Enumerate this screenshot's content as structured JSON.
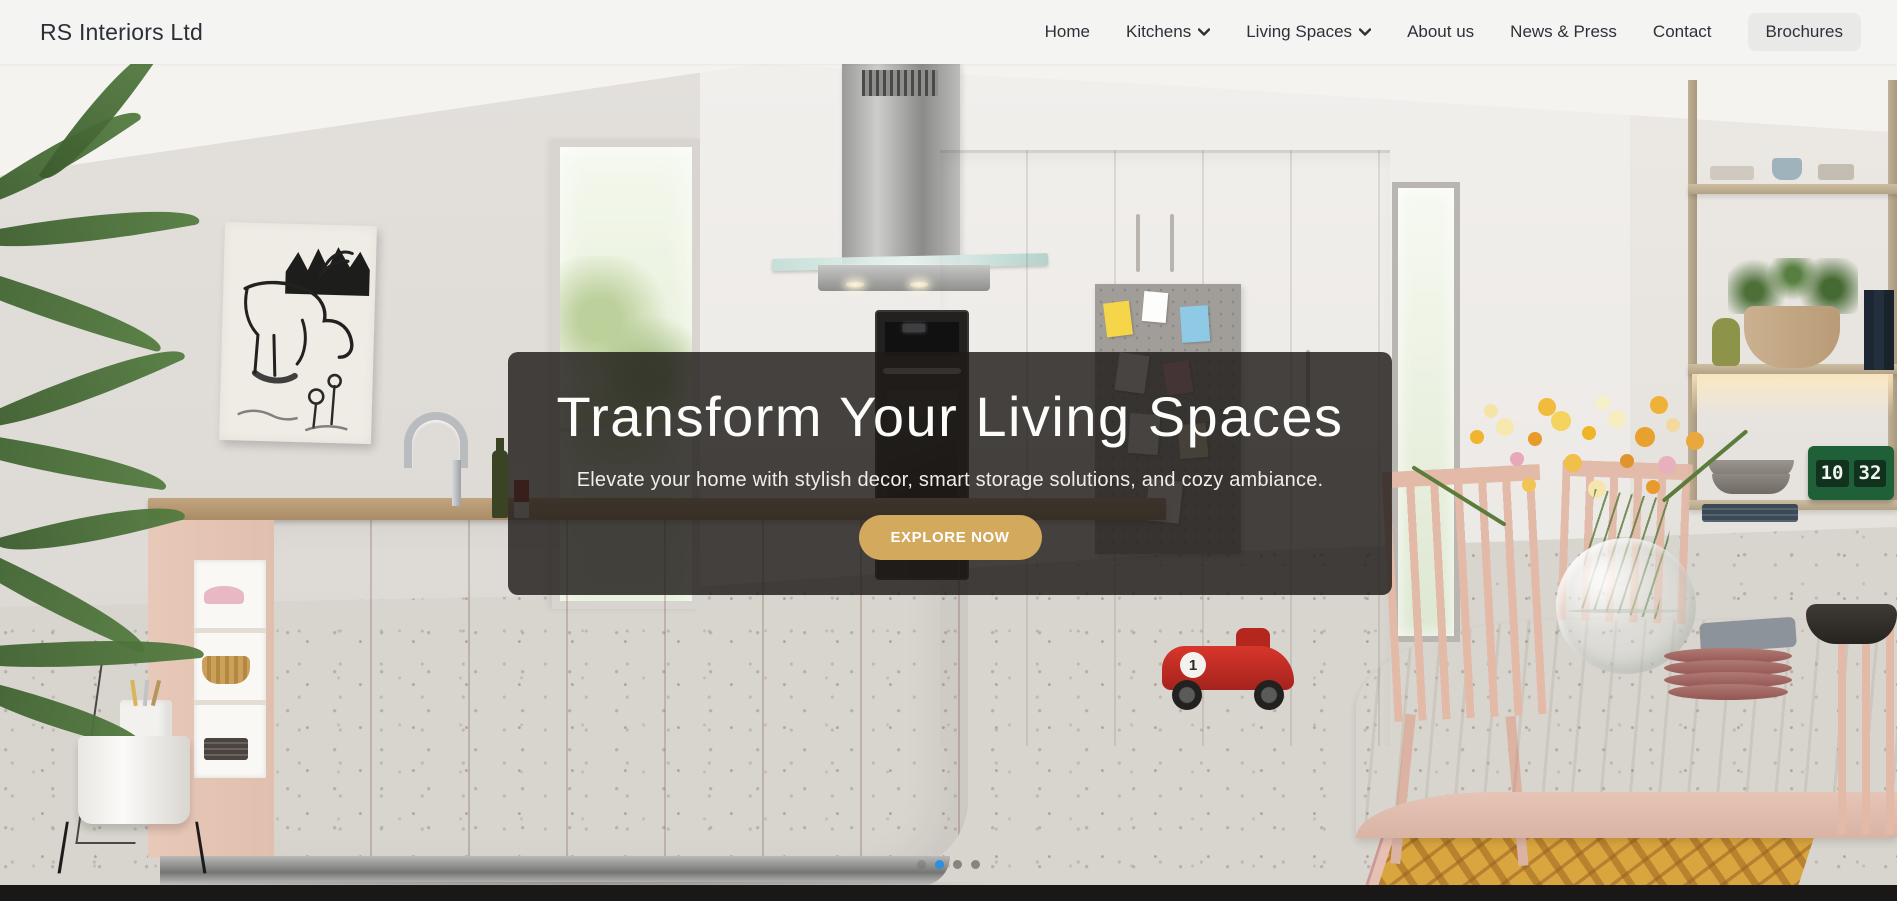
{
  "brand": {
    "name": "RS Interiors Ltd"
  },
  "nav": {
    "items": [
      {
        "label": "Home",
        "has_dropdown": false
      },
      {
        "label": "Kitchens",
        "has_dropdown": true
      },
      {
        "label": "Living Spaces",
        "has_dropdown": true
      },
      {
        "label": "About us",
        "has_dropdown": false
      },
      {
        "label": "News & Press",
        "has_dropdown": false
      },
      {
        "label": "Contact",
        "has_dropdown": false
      },
      {
        "label": "Brochures",
        "has_dropdown": false,
        "highlighted": true
      }
    ]
  },
  "hero": {
    "heading": "Transform Your Living Spaces",
    "subheading": "Elevate your home with stylish decor, smart storage solutions, and cozy ambiance.",
    "cta_label": "EXPLORE NOW",
    "cta_color": "#d3a95e",
    "overlay_color": "rgba(30,27,25,0.82)"
  },
  "carousel": {
    "active_index": 1,
    "dot_count": 4,
    "active_color": "#2b8fe6",
    "inactive_color": "#75706a"
  },
  "scene": {
    "clock_hours": "10",
    "clock_minutes": "32",
    "toy_car_number": "1"
  }
}
